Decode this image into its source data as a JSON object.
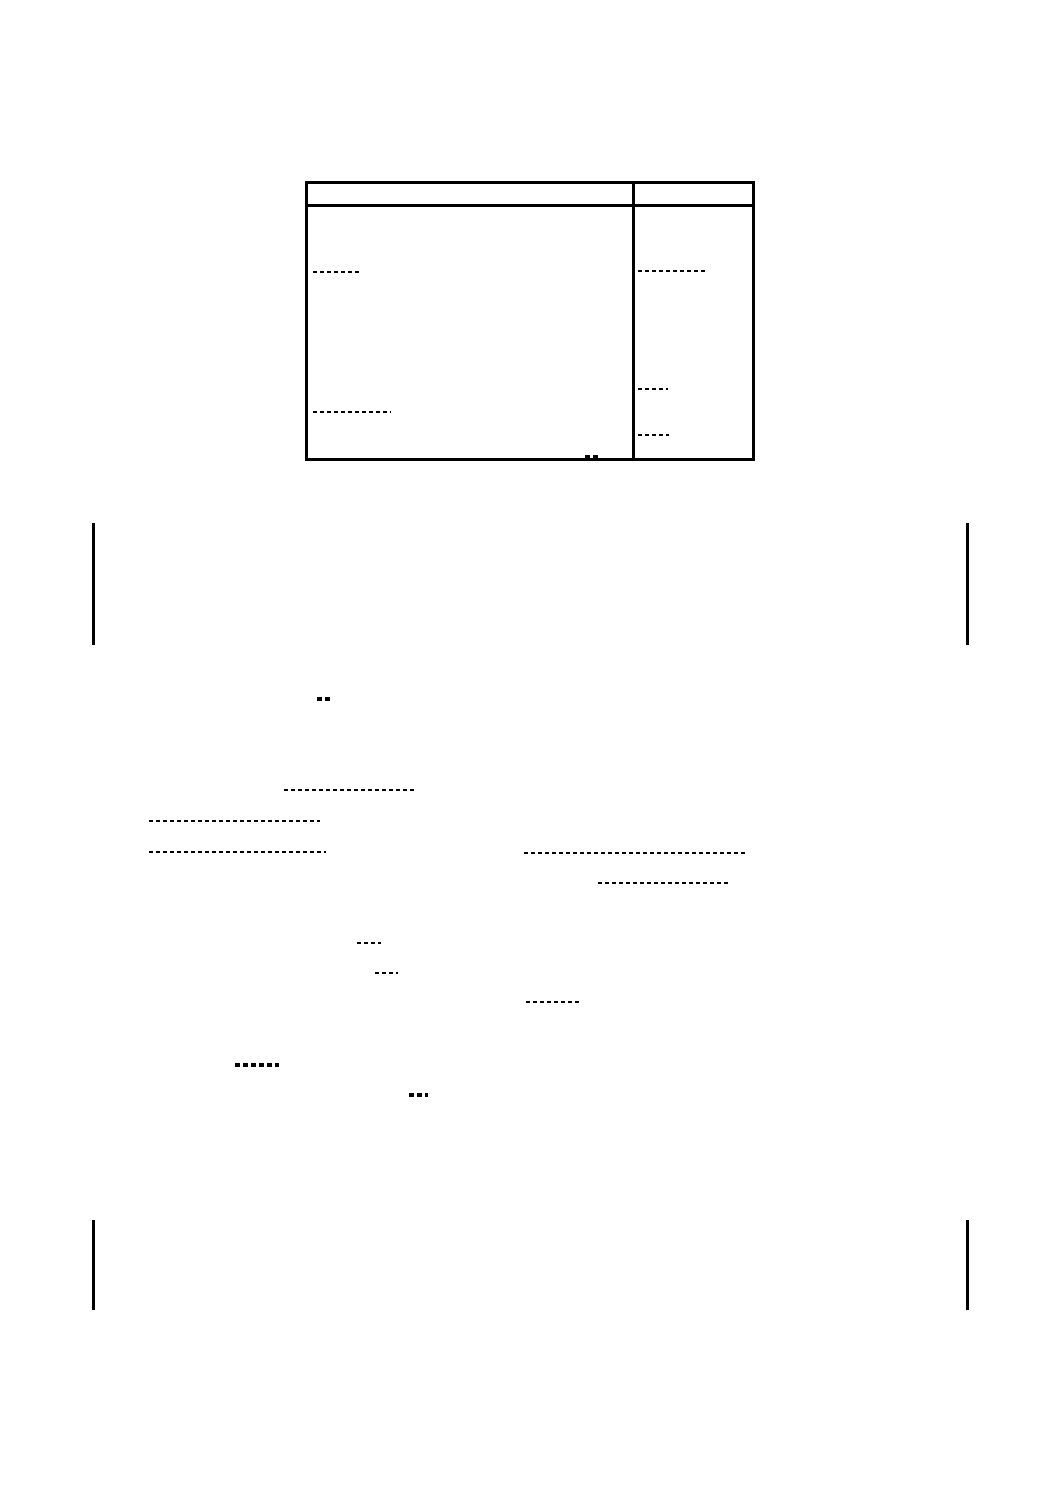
{
  "document": {
    "background_color": "#ffffff",
    "ink_color": "#000000",
    "table": {
      "x": 305,
      "y": 181,
      "width": 450,
      "height": 280,
      "header_height": 23,
      "column_divider_x": 632,
      "header_cells": [
        "",
        ""
      ],
      "cell_marks": [
        {
          "type": "dash",
          "x": 313,
          "y": 271,
          "w": 48
        },
        {
          "type": "dash",
          "x": 638,
          "y": 270,
          "w": 70
        },
        {
          "type": "dash",
          "x": 313,
          "y": 411,
          "w": 78
        },
        {
          "type": "dash",
          "x": 638,
          "y": 388,
          "w": 30
        },
        {
          "type": "dash",
          "x": 638,
          "y": 434,
          "w": 31
        },
        {
          "type": "dash-bold",
          "x": 585,
          "y": 455,
          "w": 14
        }
      ]
    },
    "body_marks": [
      {
        "type": "dash-bold",
        "x": 317,
        "y": 697,
        "w": 14
      },
      {
        "type": "dash",
        "x": 284,
        "y": 789,
        "w": 130
      },
      {
        "type": "dash",
        "x": 149,
        "y": 820,
        "w": 171
      },
      {
        "type": "dash",
        "x": 149,
        "y": 851,
        "w": 177
      },
      {
        "type": "dash",
        "x": 524,
        "y": 852,
        "w": 222
      },
      {
        "type": "dash",
        "x": 598,
        "y": 882,
        "w": 133
      },
      {
        "type": "dash",
        "x": 357,
        "y": 942,
        "w": 24
      },
      {
        "type": "dash",
        "x": 375,
        "y": 972,
        "w": 23
      },
      {
        "type": "dash",
        "x": 526,
        "y": 1001,
        "w": 55
      },
      {
        "type": "dash-bold",
        "x": 235,
        "y": 1063,
        "w": 44
      },
      {
        "type": "dash-bold",
        "x": 409,
        "y": 1093,
        "w": 19
      }
    ],
    "fold_marks": [
      {
        "type": "vbar",
        "x": 92,
        "y": 523,
        "h": 122
      },
      {
        "type": "vbar",
        "x": 966,
        "y": 523,
        "h": 122
      },
      {
        "type": "vbar",
        "x": 92,
        "y": 1220,
        "h": 90
      },
      {
        "type": "vbar",
        "x": 966,
        "y": 1220,
        "h": 90
      }
    ]
  }
}
